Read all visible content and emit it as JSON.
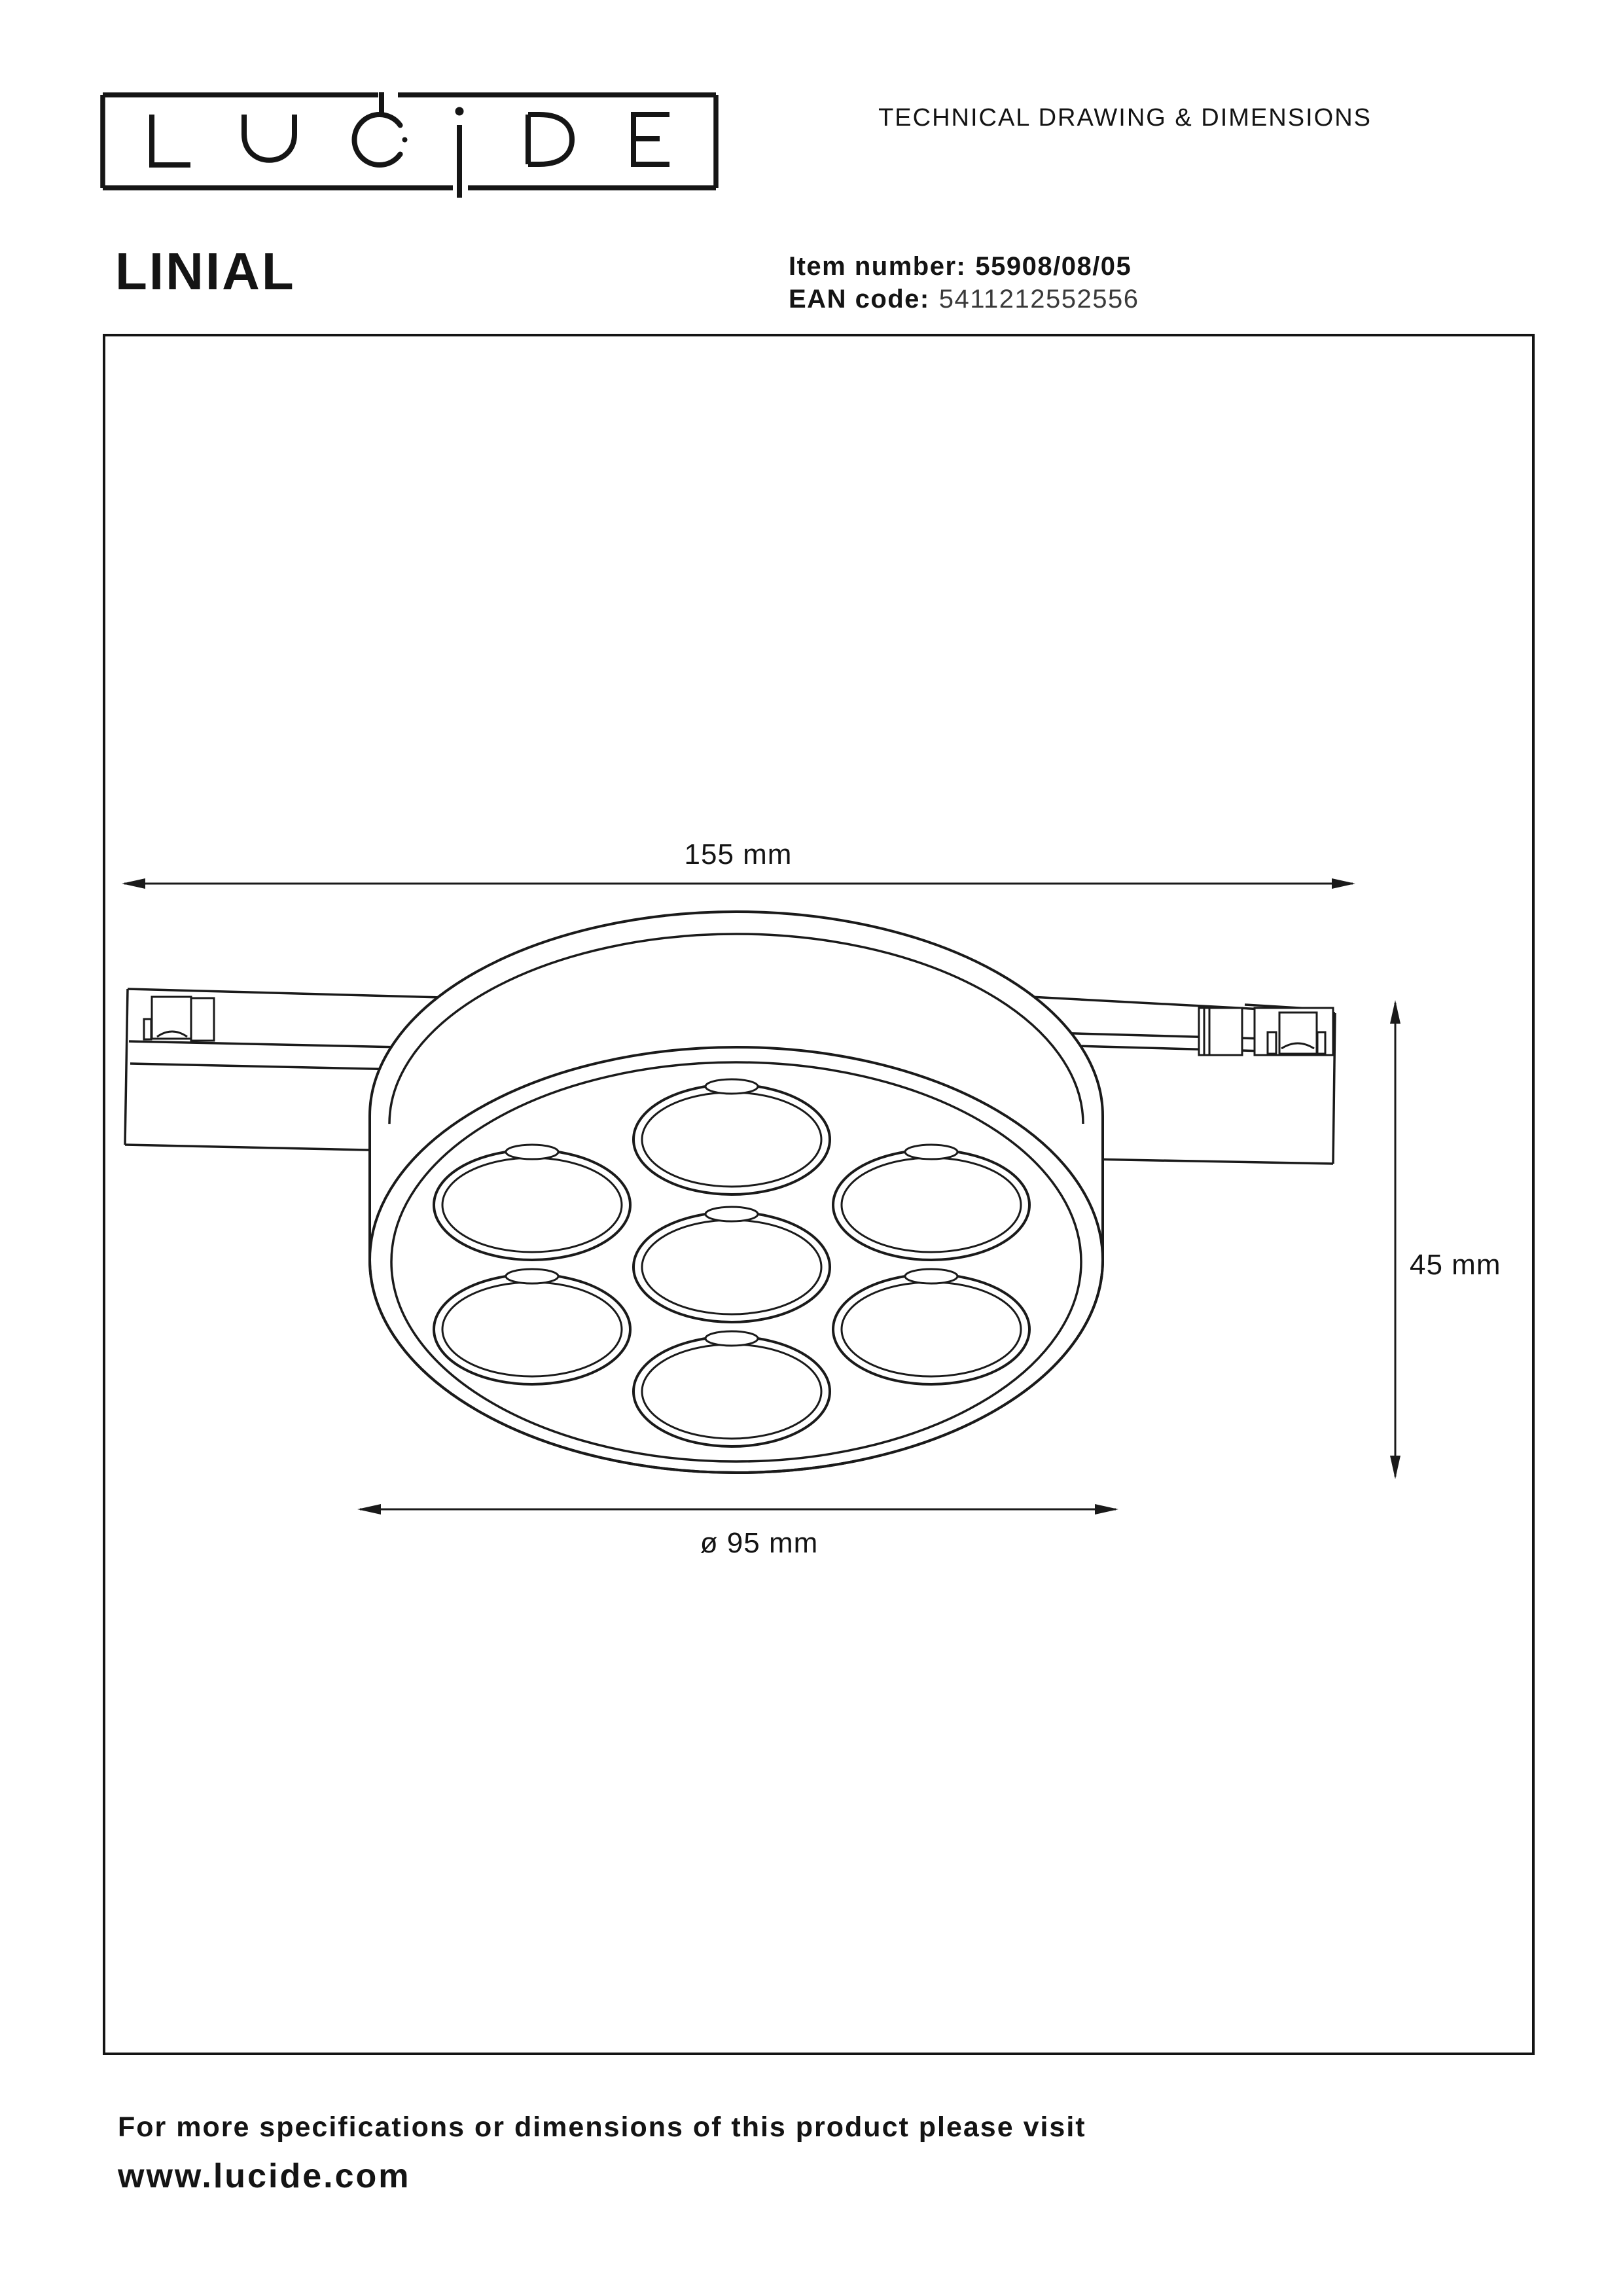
{
  "header": {
    "doc_title": "TECHNICAL DRAWING & DIMENSIONS"
  },
  "brand": {
    "logo_text": "LUCIDE"
  },
  "product": {
    "name": "LINIAL",
    "item_number_label": "Item number:",
    "item_number": "55908/08/05",
    "ean_label": "EAN code:",
    "ean": "5411212552556"
  },
  "drawing": {
    "dim_width": "155 mm",
    "dim_height": "45 mm",
    "dim_diameter": "ø 95 mm"
  },
  "footer": {
    "line1": "For more specifications or dimensions of this product please visit",
    "website": "www.lucide.com"
  },
  "colors": {
    "ink": "#1a1a1a",
    "text": "#141414"
  }
}
